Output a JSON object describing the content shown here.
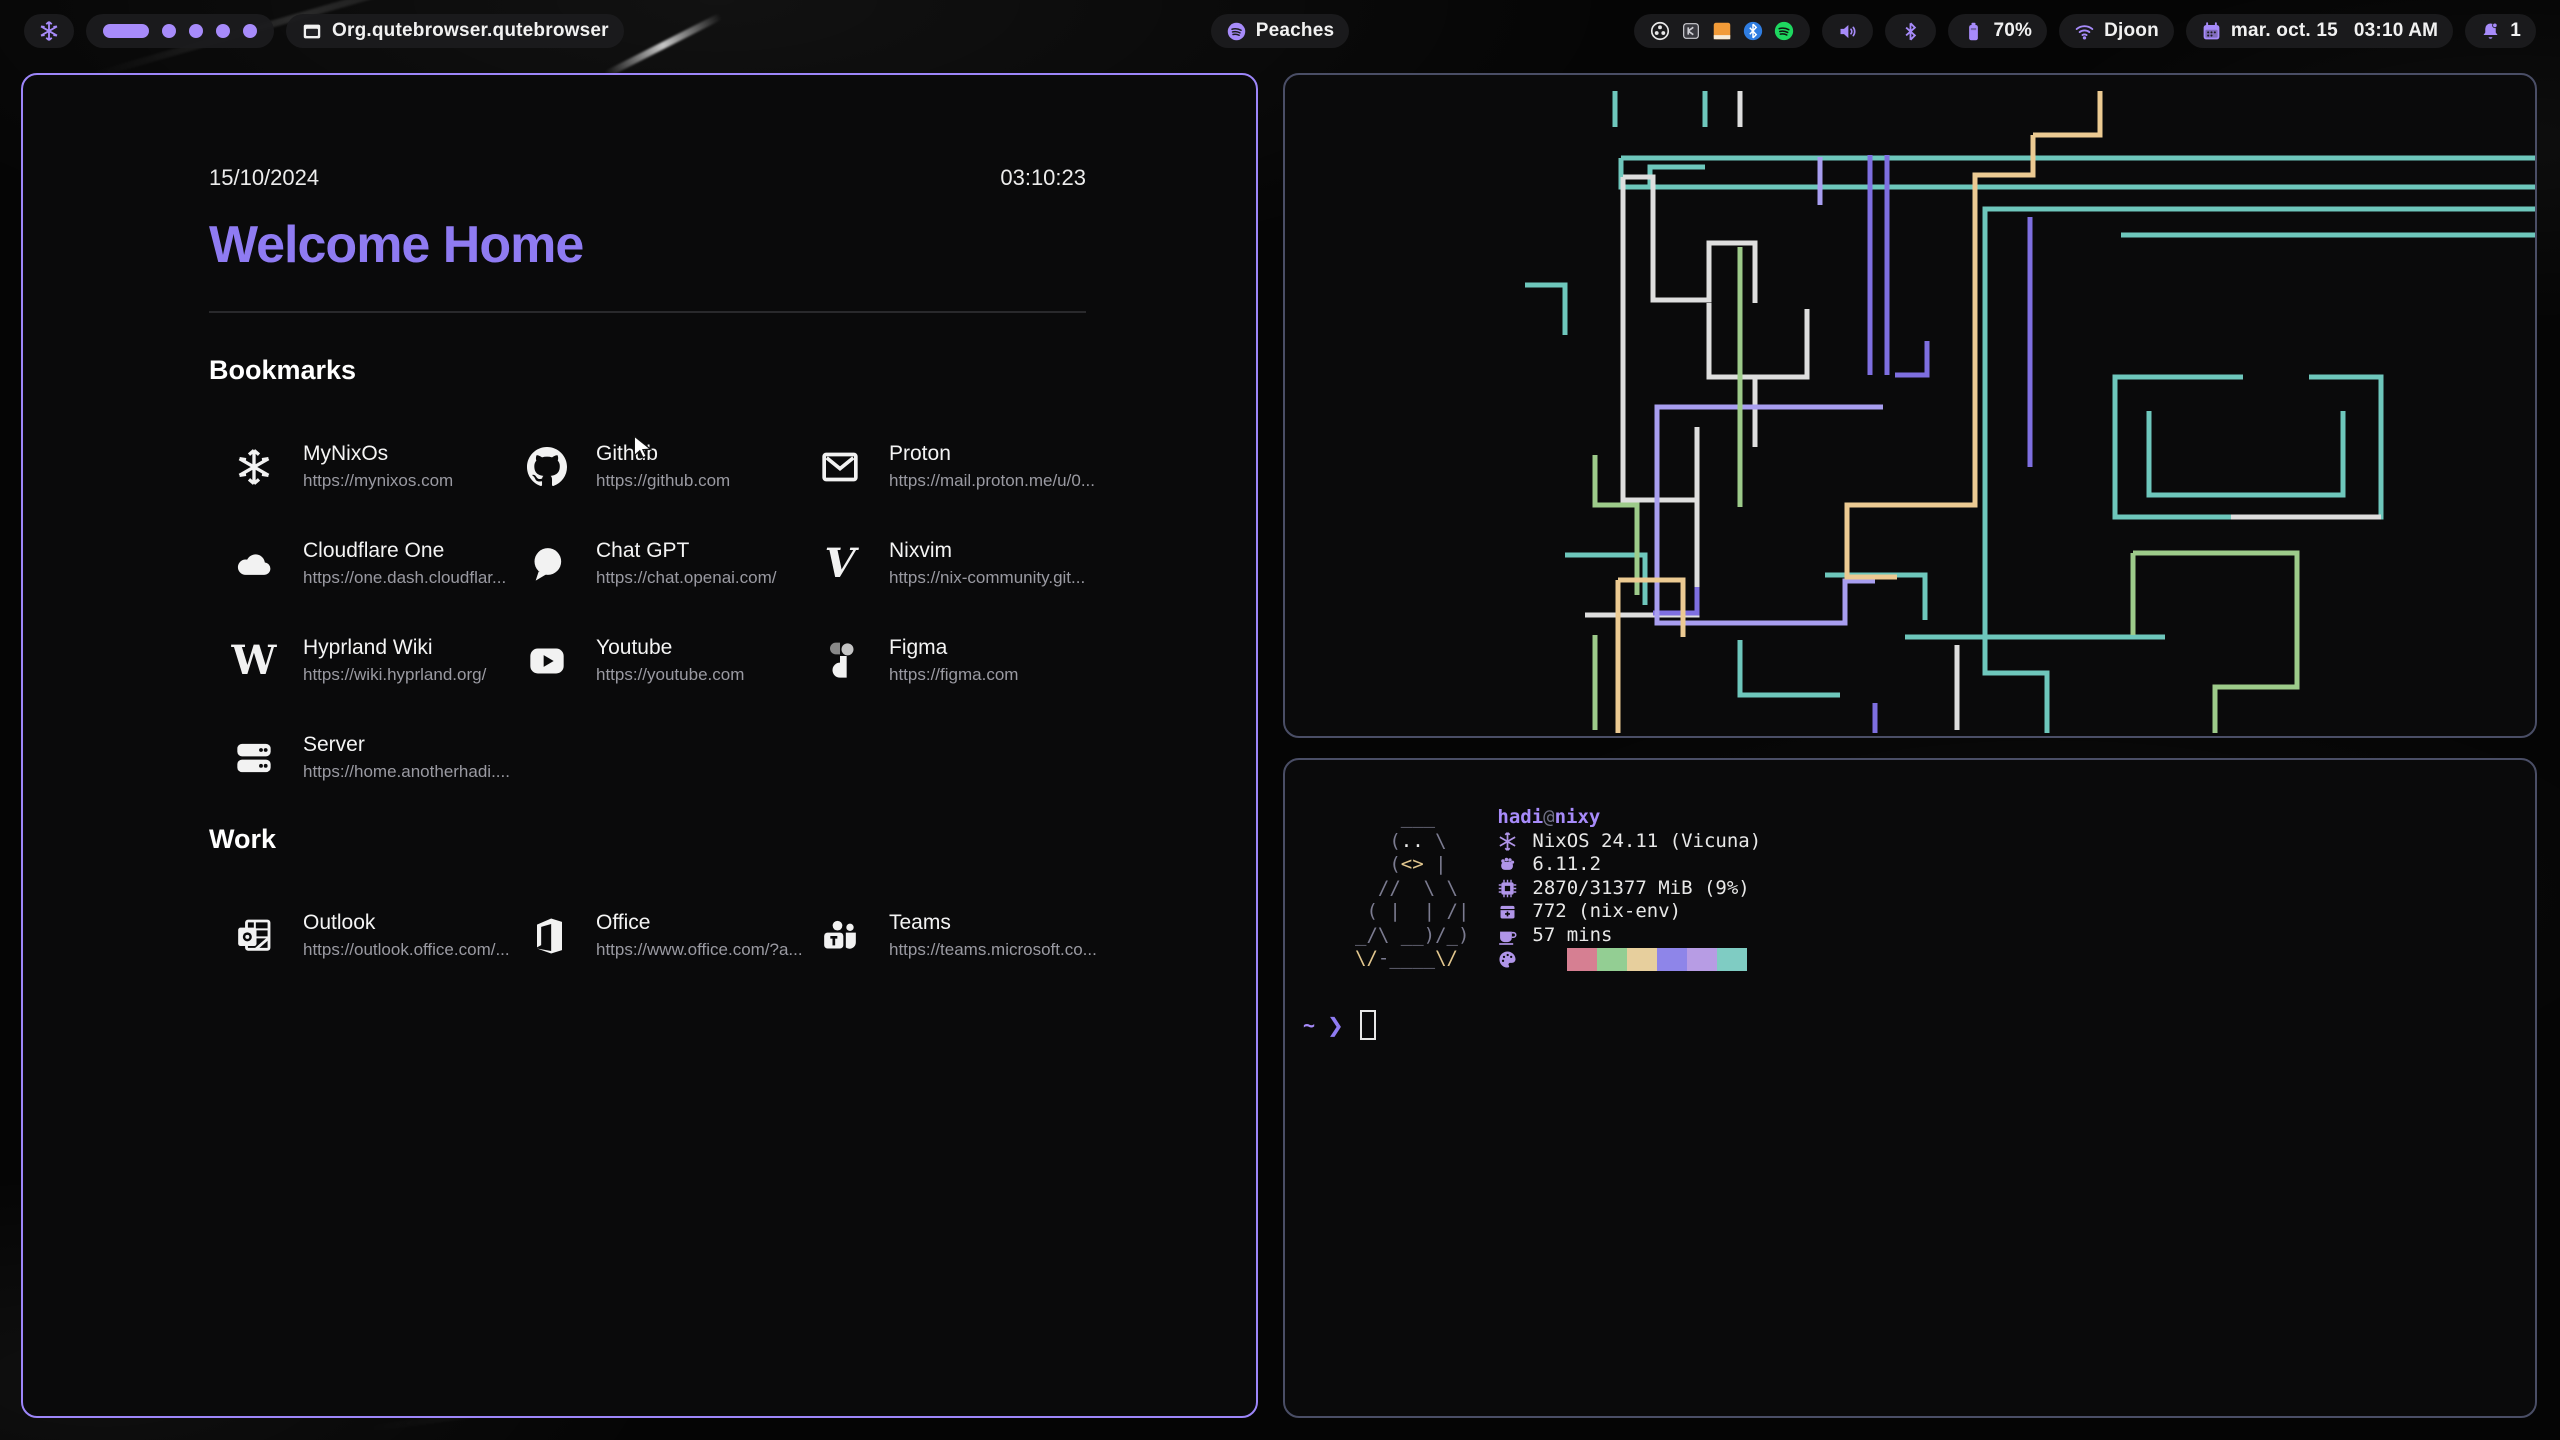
{
  "colors": {
    "accent": "#a78bfa",
    "accent-strong": "#8f7bf2",
    "text": "#f1f1f1",
    "border-active": "#9d86fa",
    "border-idle": "#4a4e66",
    "term-icon": "#b095e8",
    "tux-body": "#7b7b90",
    "tux-accent": "#e2c78e",
    "pipe-teal": "#6ec7bc",
    "pipe-white": "#dedede",
    "pipe-purple": "#7e6fe0",
    "pipe-lav": "#a89ef0",
    "pipe-green": "#9dcb8a",
    "pipe-tan": "#ecca92"
  },
  "topbar": {
    "launcher_icon": "nixos-snowflake",
    "workspaces": {
      "count": 5,
      "active": 1
    },
    "window_title": "Org.qutebrowser.qutebrowser",
    "media": {
      "icon": "spotify",
      "label": "Peaches"
    },
    "tray_icons": [
      "obs",
      "keepassxc",
      "orange-app",
      "bluetooth-blue",
      "spotify-green"
    ],
    "volume_icon": "volume",
    "bluetooth_icon": "bluetooth",
    "battery": {
      "icon": "battery",
      "label": "70%"
    },
    "network": {
      "icon": "wifi",
      "label": "Djoon"
    },
    "clock": {
      "icon": "calendar",
      "date_label": "mar. oct. 15",
      "time_label": "03:10 AM"
    },
    "notifications": {
      "icon": "bell",
      "count": "1"
    }
  },
  "startpage": {
    "date": "15/10/2024",
    "time": "03:10:23",
    "title": "Welcome Home",
    "sections": [
      {
        "heading": "Bookmarks",
        "items": [
          {
            "title": "MyNixOs",
            "url": "https://mynixos.com",
            "icon": "nixos-snowflake"
          },
          {
            "title": "Github",
            "url": "https://github.com",
            "icon": "github"
          },
          {
            "title": "Proton",
            "url": "https://mail.proton.me/u/0...",
            "icon": "envelope"
          },
          {
            "title": "Cloudflare One",
            "url": "https://one.dash.cloudflar...",
            "icon": "cloud"
          },
          {
            "title": "Chat GPT",
            "url": "https://chat.openai.com/",
            "icon": "chat-bubble"
          },
          {
            "title": "Nixvim",
            "url": "https://nix-community.git...",
            "icon": "vim-v"
          },
          {
            "title": "Hyprland Wiki",
            "url": "https://wiki.hyprland.org/",
            "icon": "wikipedia-w"
          },
          {
            "title": "Youtube",
            "url": "https://youtube.com",
            "icon": "youtube-play"
          },
          {
            "title": "Figma",
            "url": "https://figma.com",
            "icon": "figma"
          },
          {
            "title": "Server",
            "url": "https://home.anotherhadi....",
            "icon": "server-stack"
          }
        ]
      },
      {
        "heading": "Work",
        "items": [
          {
            "title": "Outlook",
            "url": "https://outlook.office.com/...",
            "icon": "outlook"
          },
          {
            "title": "Office",
            "url": "https://www.office.com/?a...",
            "icon": "office"
          },
          {
            "title": "Teams",
            "url": "https://teams.microsoft.co...",
            "icon": "teams"
          }
        ]
      }
    ]
  },
  "terminal": {
    "fetch": {
      "user": "hadi",
      "at": "@",
      "host": "nixy",
      "entries": [
        {
          "icon": "snowflake",
          "text": "NixOS 24.11 (Vicuna)"
        },
        {
          "icon": "kernel",
          "text": "6.11.2"
        },
        {
          "icon": "memory",
          "text": "2870/31377 MiB (9%)"
        },
        {
          "icon": "package",
          "text": "772 (nix-env)"
        },
        {
          "icon": "uptime",
          "text": "57 mins"
        }
      ],
      "palette_icon": "palette",
      "palette": [
        "#d67f92",
        "#93ce93",
        "#e7cf9d",
        "#8e85e9",
        "#b79ce4",
        "#7fccc3"
      ],
      "art": [
        [
          [
            "b",
            "    ___"
          ]
        ],
        [
          [
            "b",
            "   ("
          ],
          [
            "e",
            ".."
          ],
          [
            "b",
            " \\"
          ]
        ],
        [
          [
            "b",
            "   ("
          ],
          [
            "k",
            "<>"
          ],
          [
            "b",
            " |"
          ]
        ],
        [
          [
            "b",
            "  //  \\ \\"
          ]
        ],
        [
          [
            "b",
            " ( |  | /|"
          ]
        ],
        [
          [
            "b",
            "_/\\ __)/_)"
          ]
        ],
        [
          [
            "k",
            "\\/"
          ],
          [
            "b",
            "-____"
          ],
          [
            "k",
            "\\/"
          ]
        ]
      ]
    },
    "prompt": {
      "path": "~",
      "symbol": "❯"
    }
  }
}
